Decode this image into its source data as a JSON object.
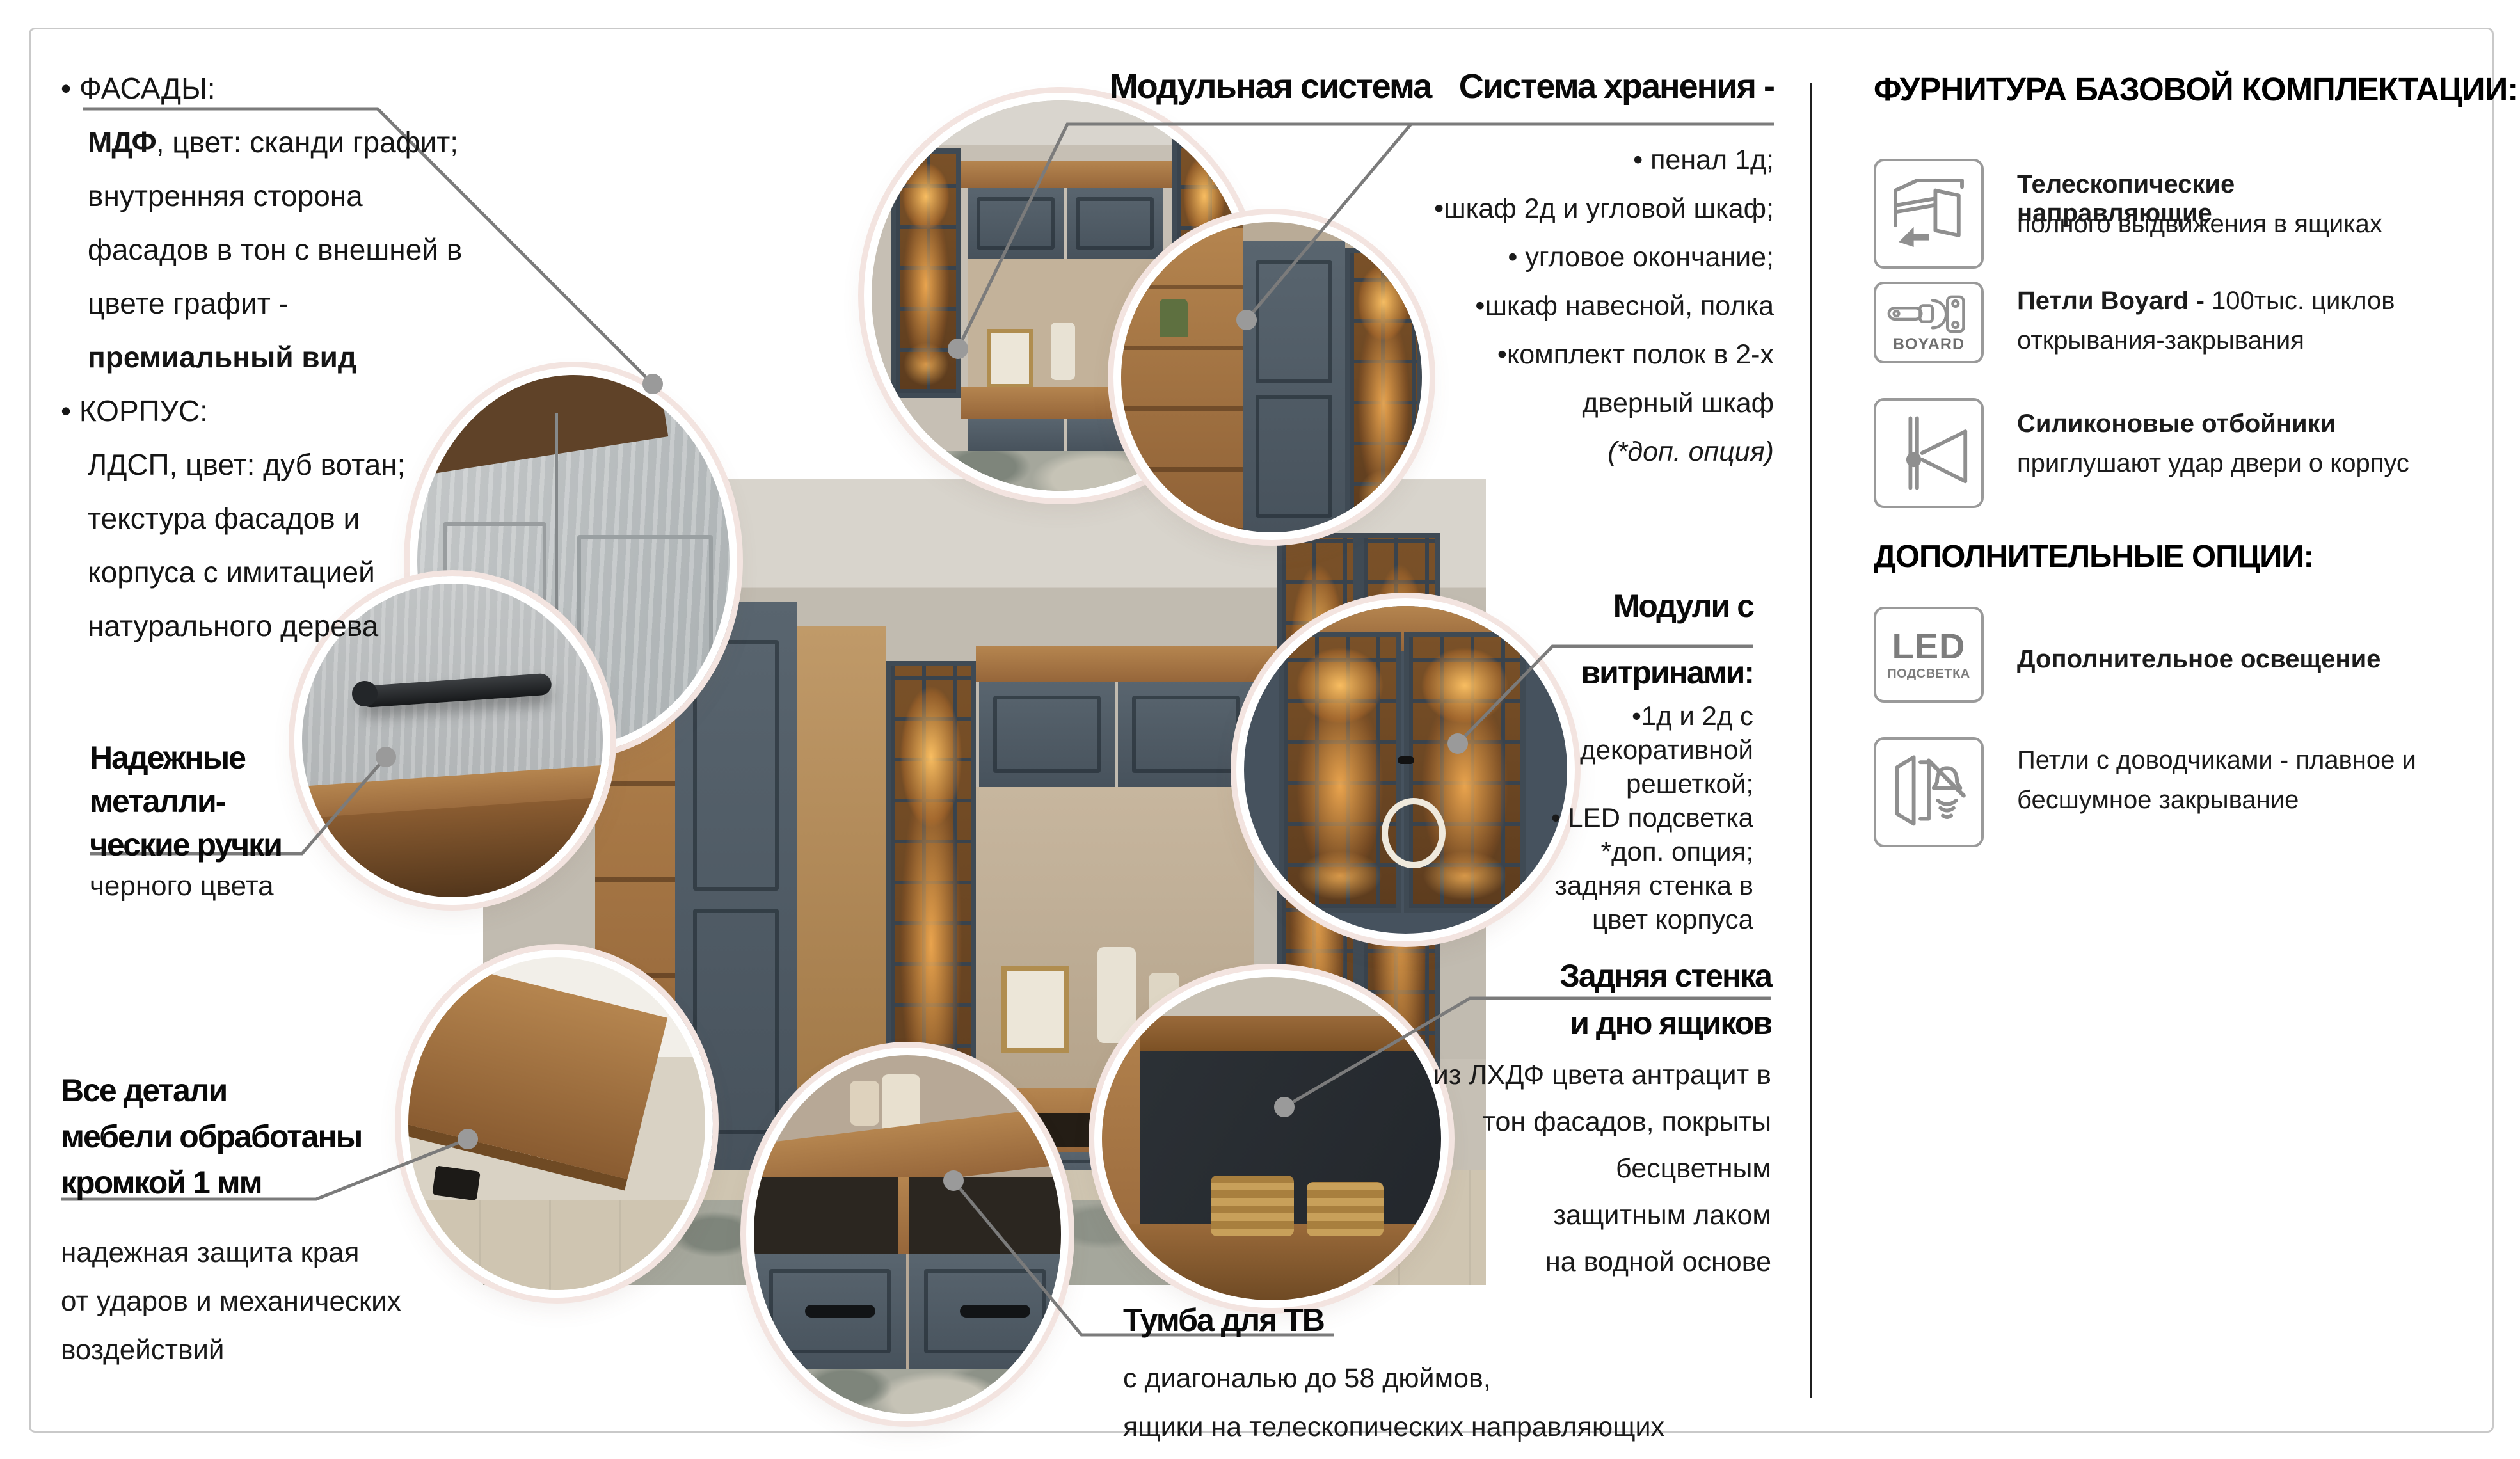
{
  "left_specs": {
    "t1": "• ФАСАДЫ:",
    "mdf_b": "МДФ",
    "mdf_r": ", цвет: сканди графит;",
    "l3": "внутренняя сторона",
    "l4": "фасадов в тон с внешней в",
    "l5": "цвете графит -",
    "l6": "премиальный вид",
    "t7": "• КОРПУС:",
    "l8": "ЛДСП, цвет: дуб вотан;",
    "l9": "текстура фасадов и",
    "l10": "корпуса с имитацией",
    "l11": "натурального дерева"
  },
  "callouts": {
    "modular": {
      "title": "Модульная система"
    },
    "storage": {
      "title": "Система хранения -",
      "items": [
        "• пенал 1д;",
        "•шкаф 2д и угловой шкаф;",
        "• угловое окончание;",
        "•шкаф навесной, полка",
        "•комплект полок в 2-х",
        "дверный шкаф"
      ],
      "note": "(*доп. опция)"
    },
    "handles": {
      "t1": "Надежные",
      "t2": "металли-",
      "t3": "ческие ручки",
      "sub": "черного цвета"
    },
    "vitrines": {
      "t1": "Модули с",
      "t2": "витринами:",
      "i1": "•1д и 2д с",
      "i2": "декоративной",
      "i3": "решеткой;",
      "i4": "• LED подсветка",
      "i5": "*доп. опция;",
      "i6": "задняя стенка в",
      "i7": "цвет корпуса"
    },
    "edges": {
      "t1": "Все детали",
      "t2": "мебели обработаны",
      "t3": "кромкой 1 мм",
      "s1": "надежная защита края",
      "s2": "от ударов и механических",
      "s3": "воздействий"
    },
    "tv": {
      "title": "Тумба для ТВ",
      "s1": "с диагональю до 58 дюймов,",
      "s2": "ящики на телескопических направляющих"
    },
    "backwall": {
      "t1": "Задняя стенка",
      "t2": "и дно ящиков",
      "s1": "из ЛХДФ цвета антрацит в",
      "s2": "тон фасадов, покрыты",
      "s3": "бесцветным",
      "s4": "защитным лаком",
      "s5": "на водной основе"
    }
  },
  "sidebar": {
    "header1": "ФУРНИТУРА БАЗОВОЙ КОМПЛЕКТАЦИИ:",
    "item1": {
      "bold": "Телескопические направляющие",
      "rest": "полного выдвижения в ящиках"
    },
    "item2": {
      "badge": "BOYARD",
      "bold": "Петли Boyard - ",
      "rest1": "100тыс. циклов",
      "rest2": "открывания-закрывания"
    },
    "item3": {
      "bold": "Силиконовые отбойники",
      "rest": "приглушают удар двери о корпус"
    },
    "header2": "ДОПОЛНИТЕЛЬНЫЕ ОПЦИИ:",
    "led": {
      "label": "LED",
      "sub": "ПОДСВЕТКА",
      "text": "Дополнительное освещение"
    },
    "soft": {
      "l1": "Петли с доводчиками - плавное и",
      "l2": "бесшумное закрывание"
    }
  },
  "colors": {
    "ring": "#f3e4e0",
    "connector_line": "#7b7b7b",
    "connector_dot": "#9a9a9a",
    "divider": "#1f1f1f",
    "frame": "#c9c9c9",
    "icon_stroke": "#8f8f8f",
    "cabinet_blue": "#4e5a66",
    "wood": "#a5743f",
    "led_glow": "#e89a44"
  }
}
